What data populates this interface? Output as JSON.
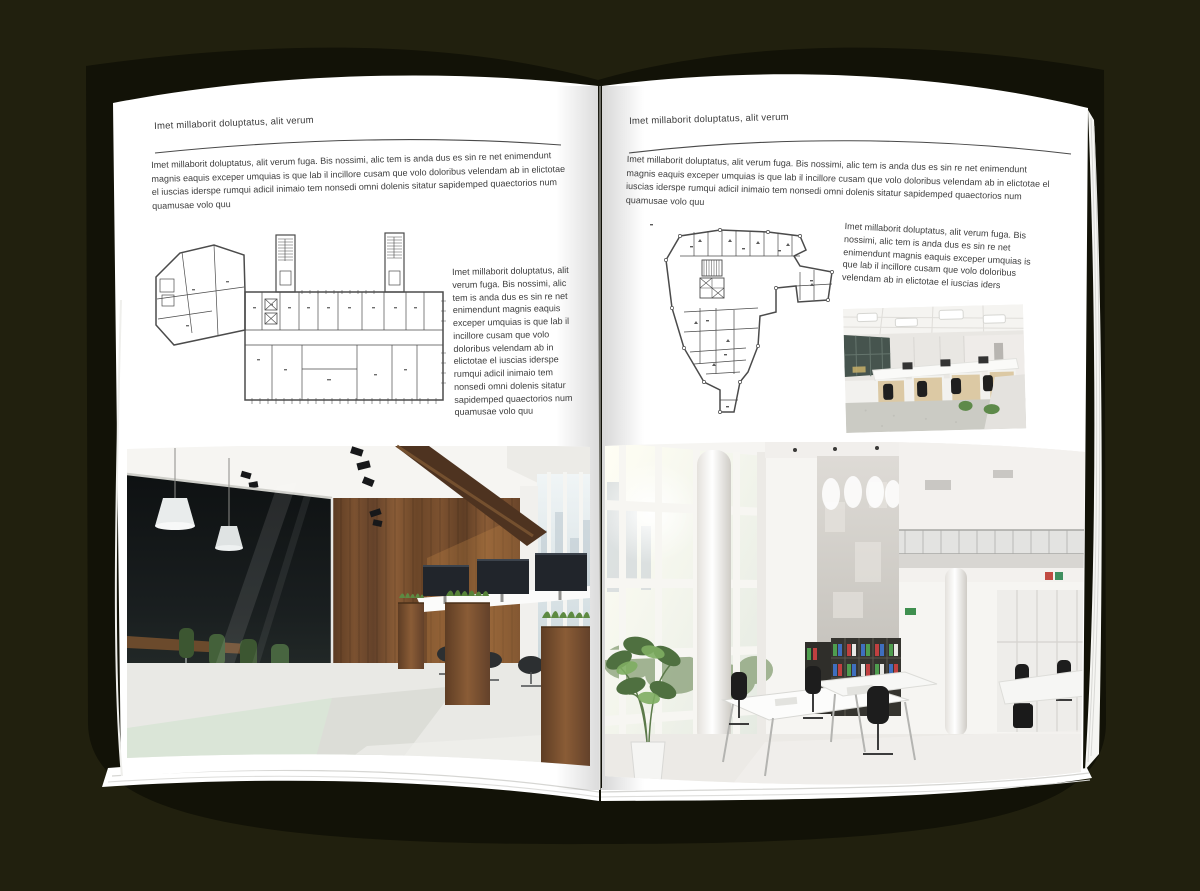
{
  "colors": {
    "background": "#21200e",
    "paper": "#ffffff",
    "text": "#3d3d3d",
    "rule": "#4a4a4a",
    "wood_accent": "#7a5230",
    "plant_green": "#5d8a42",
    "binder_green": "#4f9e4f",
    "binder_blue": "#3f6fbf",
    "binder_red": "#c04040"
  },
  "left_page": {
    "header": "Imet millaborit doluptatus, alit verum",
    "intro": "Imet millaborit doluptatus, alit verum fuga. Bis nossimi, alic tem is anda dus es sin re net enimendunt magnis eaquis exceper umquias is que lab il incillore cusam que volo doloribus velendam ab in elictotae el iuscias iderspe rumqui adicil inimaio tem nonsedi omni dolenis sitatur sapidemped quaectorios num quamusae volo quu",
    "caption": "Imet millaborit doluptatus, alit verum fuga. Bis nossimi, alic tem is anda dus es sin re net enimendunt magnis eaquis exceper umquias is que lab il incillore cusam que volo doloribus velendam ab in elictotae el iuscias iderspe rumqui adicil inimaio tem nonsedi omni dolenis sitatur sapidemped quaectorios num quamusae volo quu"
  },
  "right_page": {
    "header": "Imet millaborit doluptatus, alit verum",
    "intro": "Imet millaborit doluptatus, alit verum fuga. Bis nossimi, alic tem is anda dus es sin re net enimendunt magnis eaquis exceper umquias is que lab il incillore cusam que volo doloribus velendam ab in elictotae el iuscias iderspe rumqui adicil inimaio tem nonsedi omni dolenis sitatur sapidemped quaectorios num quamusae volo quu",
    "caption": "Imet millaborit doluptatus, alit verum fuga. Bis nossimi, alic tem is anda dus es sin re net enimendunt magnis eaquis exceper umquias is que lab il incillore cusam que volo doloribus velendam ab in elictotae el iuscias iders"
  }
}
